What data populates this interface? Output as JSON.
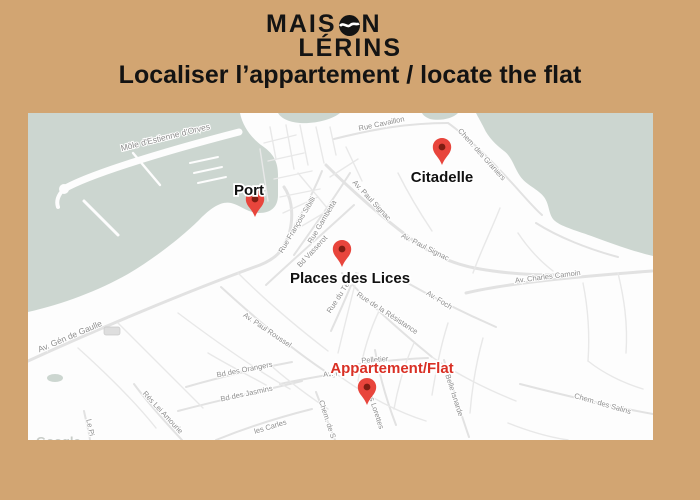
{
  "logo": {
    "line1_pre": "MAIS",
    "line1_post": "N",
    "line2": "LÉRINS"
  },
  "title": "Localiser l’appartement / locate the flat",
  "map": {
    "attribution": "Google",
    "markers": [
      {
        "name": "port",
        "label": "Port"
      },
      {
        "name": "citadelle",
        "label": "Citadelle"
      },
      {
        "name": "places-des-lices",
        "label": "Places des Lices"
      },
      {
        "name": "appartement",
        "label": "Appartement/Flat"
      }
    ],
    "streets": [
      "Môle d'Estienne d'Orves",
      "Rue Cavaillon",
      "Chem. des Graniers",
      "Av. Paul Signac",
      "Av. Paul Signac",
      "Rue Gambetta",
      "Rue François Sibilli",
      "Bd Vasserot",
      "Av. Charles Camoin",
      "Av. Foch",
      "Rue de la Résistance",
      "Rue du Té",
      "Av. Paul Roussel",
      "Av. Gén de Gaulle",
      "Bd des Orangers",
      "Bd des Jasmins",
      "Rés Lei Amourie",
      "les Carles",
      "Chem. des Salins",
      "Chem. de S",
      "des Lorettes",
      "Pelletier",
      "Av. Fr",
      "Belle Isnarde",
      "Le Pi"
    ]
  },
  "colors": {
    "background": "#d2a572",
    "sea": "#ccd6d0",
    "land": "#fdfdfd",
    "marker_red": "#e8453c",
    "label_red": "#d93025",
    "text_dark": "#131313"
  }
}
